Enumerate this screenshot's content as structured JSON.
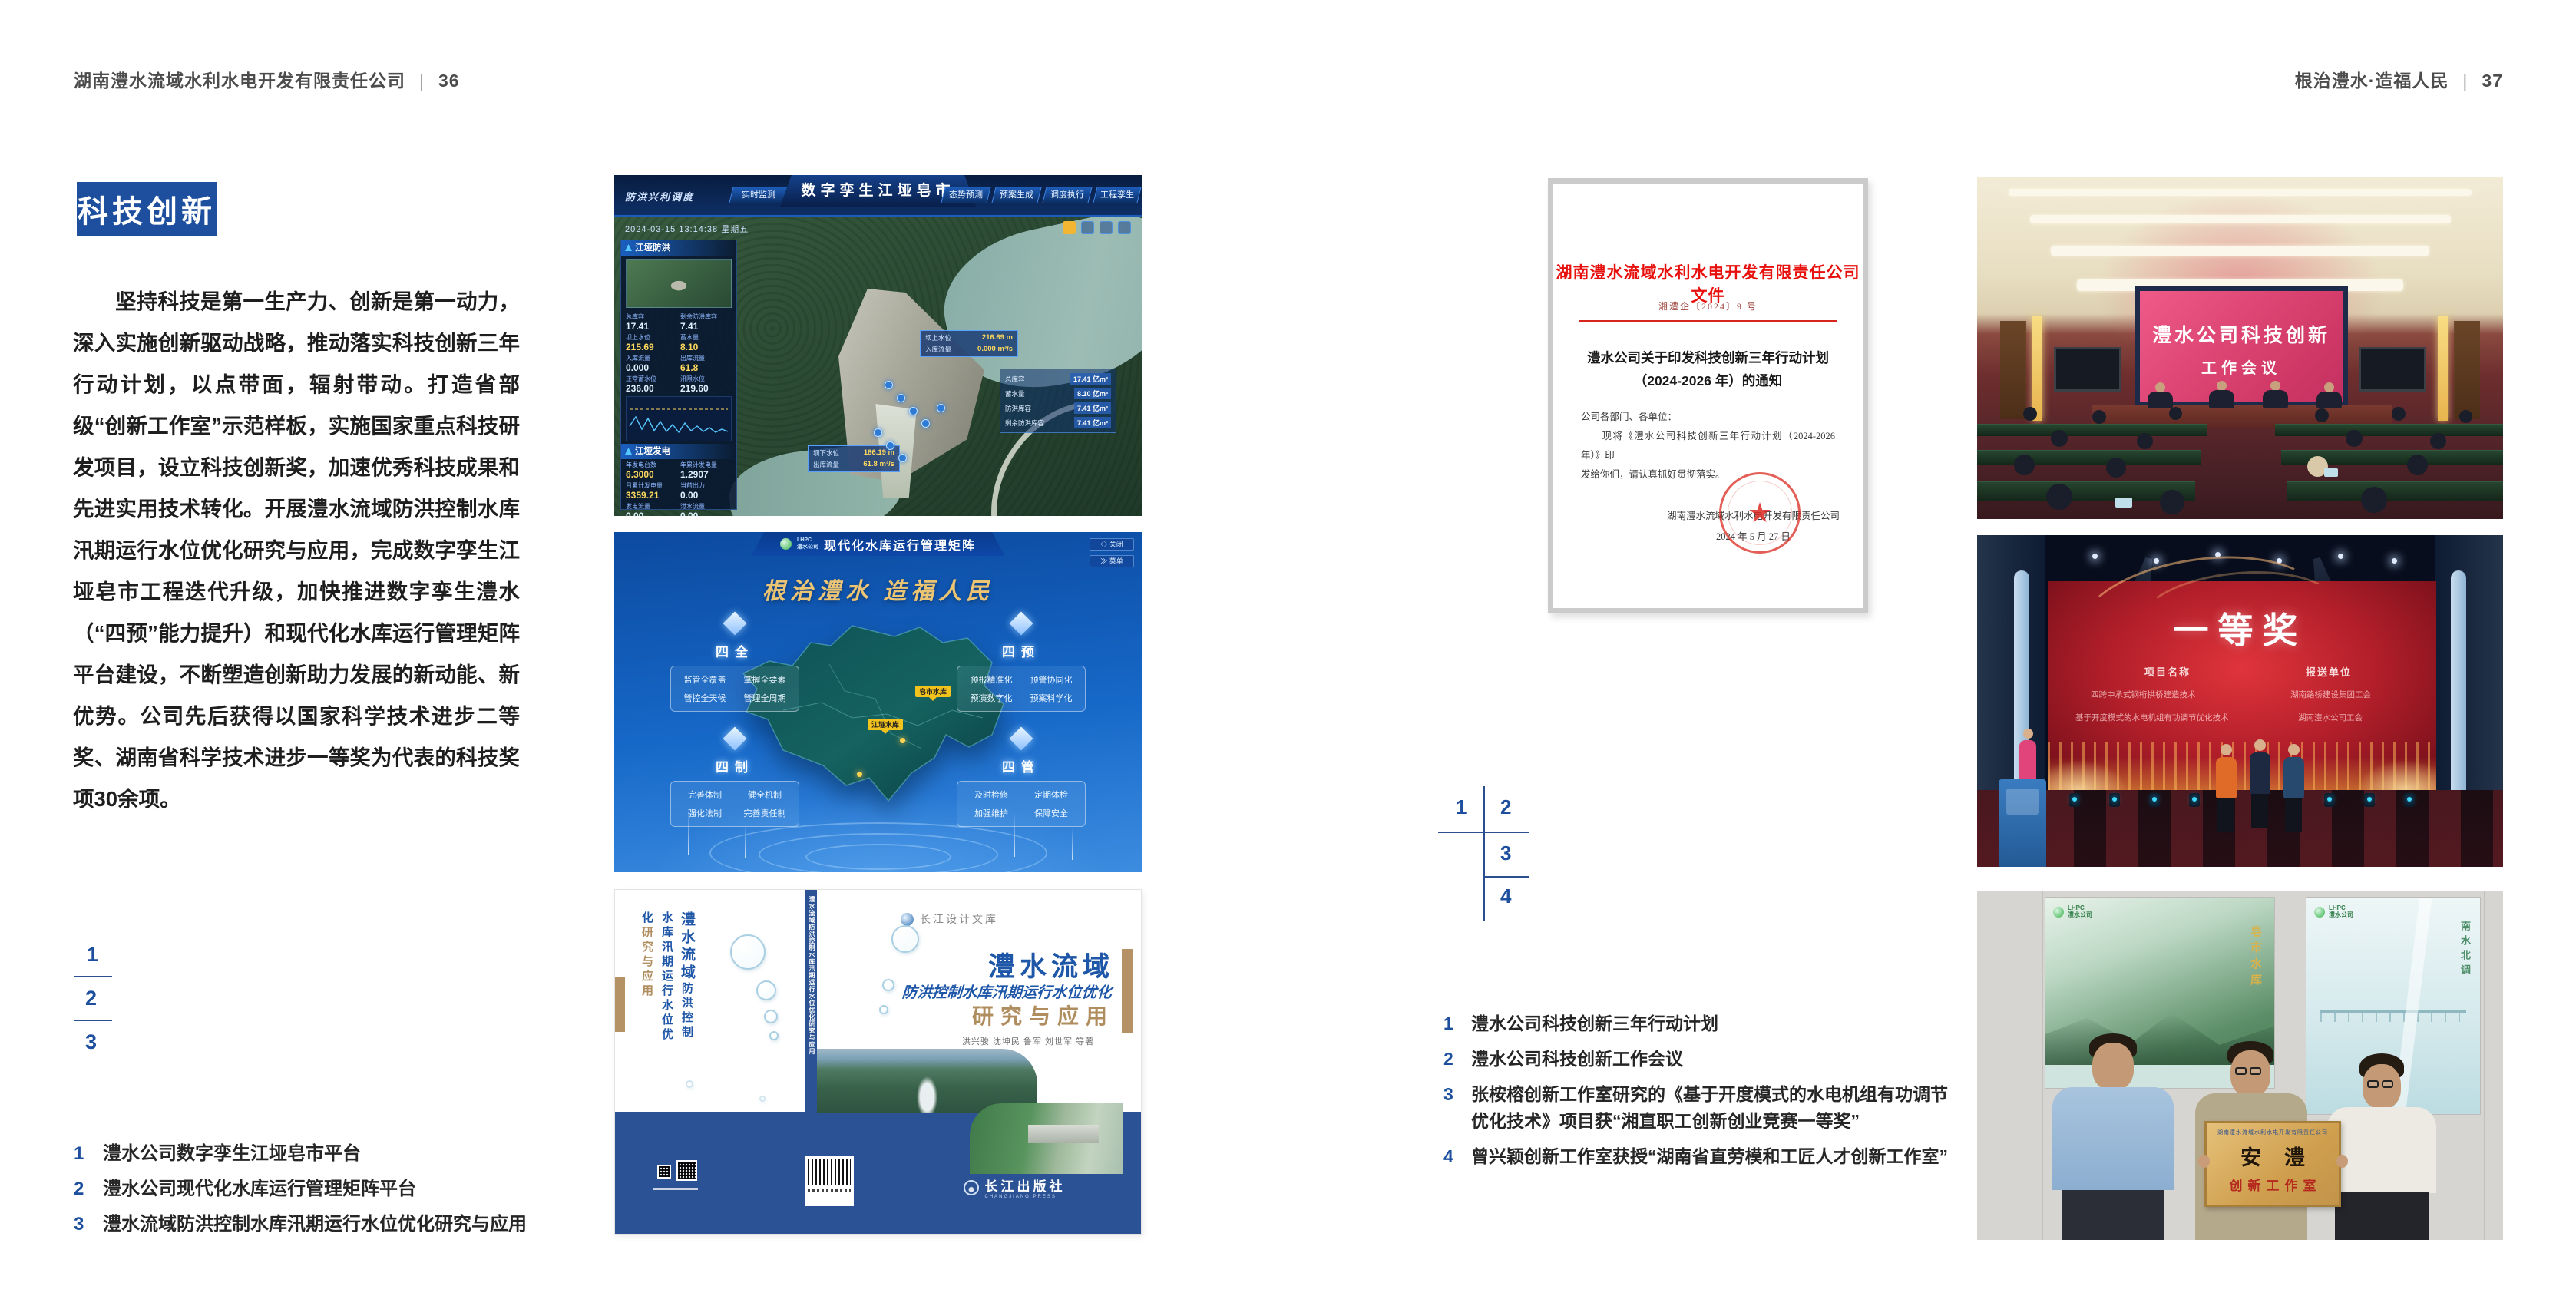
{
  "accent_blue": "#1d4f9e",
  "left_page": {
    "header": {
      "title": "湖南澧水流域水利水电开发有限责任公司",
      "divider": "|",
      "page_no": "36"
    },
    "section_title": "科技创新",
    "paragraph": "坚持科技是第一生产力、创新是第一动力，深入实施创新驱动战略，推动落实科技创新三年行动计划，以点带面，辐射带动。打造省部级“创新工作室”示范样板，实施国家重点科技研发项目，设立科技创新奖，加速优秀科技成果和先进实用技术转化。开展澧水流域防洪控制水库汛期运行水位优化研究与应用，完成数字孪生江垭皂市工程迭代升级，加快推进数字孪生澧水（“四预”能力提升）和现代化水库运行管理矩阵平台建设，不断塑造创新助力发展的新动能、新优势。公司先后获得以国家科学技术进步二等奖、湖南省科学技术进步一等奖为代表的科技奖项30余项。",
    "figure_numbers": [
      "1",
      "2",
      "3"
    ],
    "captions": [
      {
        "num": "1",
        "text": "澧水公司数字孪生江垭皂市平台"
      },
      {
        "num": "2",
        "text": "澧水公司现代化水库运行管理矩阵平台"
      },
      {
        "num": "3",
        "text": "澧水流域防洪控制水库汛期运行水位优化研究与应用"
      }
    ],
    "fig_dt": {
      "title": "数字孪生江垭皂市",
      "module": "防洪兴利调度",
      "tabs_left": [
        "实时监测",
        "洪水预报",
        "防洪预警"
      ],
      "tabs_right": [
        "态势预测",
        "预案生成",
        "调度执行",
        "工程孪生"
      ],
      "timestamp": "2024-03-15 13:14:38 星期五",
      "panel_flood": {
        "title": "江垭防洪",
        "stats": [
          {
            "l": "总库容",
            "v": "17.41"
          },
          {
            "l": "剩余防洪库容",
            "v": "7.41"
          },
          {
            "l": "坝上水位",
            "v": "215.69"
          },
          {
            "l": "蓄水量",
            "v": "8.10"
          },
          {
            "l": "入库流量",
            "v": "0.000"
          },
          {
            "l": "出库流量",
            "v": "61.8"
          },
          {
            "l": "正常蓄水位",
            "v": "236.00"
          },
          {
            "l": "汛限水位",
            "v": "219.60"
          }
        ],
        "legend": "◆ 坝上水位　◆ 入库流量　◆ 出库流量"
      },
      "panel_power": {
        "title": "江垭发电",
        "stats": [
          {
            "l": "年发电台数",
            "v": "6.3000"
          },
          {
            "l": "年累计发电量",
            "v": "1.2907"
          },
          {
            "l": "月累计发电量",
            "v": "3359.21"
          },
          {
            "l": "当前出力",
            "v": "0.00"
          },
          {
            "l": "发电流量",
            "v": "0.00"
          },
          {
            "l": "泄水流量",
            "v": "0.00"
          }
        ]
      },
      "tag_upper": {
        "rows": [
          {
            "l": "坝上水位",
            "v": "216.69 m"
          },
          {
            "l": "入库流量",
            "v": "0.000 m³/s"
          }
        ]
      },
      "tag_lower": {
        "rows": [
          {
            "l": "坝下水位",
            "v": "186.19 m"
          },
          {
            "l": "出库流量",
            "v": "61.8 m³/s"
          }
        ]
      },
      "info_panel": {
        "rows": [
          {
            "l": "总库容",
            "v": "17.41 亿m³"
          },
          {
            "l": "蓄水量",
            "v": "8.10 亿m³"
          },
          {
            "l": "防洪库容",
            "v": "7.41 亿m³"
          },
          {
            "l": "剩余防洪库容",
            "v": "7.41 亿m³"
          }
        ]
      }
    },
    "fig_matrix": {
      "logo_line1": "LHPC",
      "logo_line2": "澧水公司",
      "title": "现代化水库运行管理矩阵",
      "btn_close": "◇ 关闭",
      "btn_menu": "≫ 菜单",
      "slogan": "根治澧水 造福人民",
      "groups": [
        {
          "name": "四全",
          "items": [
            "监管全覆盖",
            "掌握全要素",
            "管控全天候",
            "管理全周期"
          ]
        },
        {
          "name": "四预",
          "items": [
            "预报精准化",
            "预警协同化",
            "预演数字化",
            "预案科学化"
          ]
        },
        {
          "name": "四制",
          "items": [
            "完善体制",
            "健全机制",
            "强化法制",
            "完善责任制"
          ]
        },
        {
          "name": "四管",
          "items": [
            "及时检修",
            "定期体检",
            "加强维护",
            "保障安全"
          ]
        }
      ],
      "markers": [
        "皂市水库",
        "江垭水库"
      ]
    },
    "fig_book": {
      "series": "长江设计文库",
      "title": "澧水流域",
      "subtitle": "防洪控制水库汛期运行水位优化",
      "title2": "研究与应用",
      "authors": "洪兴骏  沈坤民  鲁军  刘世军  等著",
      "spine_text": "澧水流域防洪控制水库汛期运行水位优化研究与应用",
      "back_title1": "澧水流域",
      "back_title2": "防洪控制水库汛期运行水位优化",
      "back_title3": "研究与应用",
      "publisher": "长江出版社",
      "publisher_en": "CHANGJIANG PRESS"
    }
  },
  "right_page": {
    "header": {
      "title": "根治澧水·造福人民",
      "divider": "|",
      "page_no": "37"
    },
    "figure_numbers": [
      "1",
      "2",
      "3",
      "4"
    ],
    "captions": [
      {
        "num": "1",
        "line1": "澧水公司科技创新三年行动计划",
        "line2": ""
      },
      {
        "num": "2",
        "line1": "澧水公司科技创新工作会议",
        "line2": ""
      },
      {
        "num": "3",
        "line1": "张桉榕创新工作室研究的《基于开度模式的水电机组有功调节",
        "line2": "优化技术》项目获“湘直职工创新创业竞赛一等奖”"
      },
      {
        "num": "4",
        "line1": "曾兴颖创新工作室获授“湖南省直劳模和工匠人才创新工作室”",
        "line2": ""
      }
    ],
    "fig_doc": {
      "letterhead": "湖南澧水流域水利水电开发有限责任公司文件",
      "doc_no": "湘澧企〔2024〕9 号",
      "title1": "澧水公司关于印发科技创新三年行动计划",
      "title2": "（2024-2026 年）的通知",
      "salutation": "公司各部门、各单位：",
      "body1": "　　现将《澧水公司科技创新三年行动计划（2024-2026 年）》印",
      "body2": "发给你们，请认真抓好贯彻落实。",
      "signer": "湖南澧水流域水利水电开发有限责任公司",
      "date": "2024 年 5 月 27 日",
      "star": "★"
    },
    "fig_meeting": {
      "screen1": "澧水公司科技创新",
      "screen2": "工作会议"
    },
    "fig_award": {
      "prize": "一等奖",
      "col1_header": "项目名称",
      "col2_header": "报送单位",
      "col1_items": [
        "四跨中承式钢桁拱桥建造技术",
        "基于开度模式的水电机组有功调节优化技术"
      ],
      "col2_items": [
        "湖南路桥建设集团工会",
        "湖南澧水公司工会"
      ]
    },
    "fig_group": {
      "plaque_header": "湖南澧水流域水利水电开发有限责任公司",
      "plaque_char1": "安",
      "plaque_char2": "澧",
      "plaque_sub": "创新工作室",
      "posterL_logo_line1": "LHPC",
      "posterL_logo_line2": "澧水公司",
      "posterL_caption": "皂市水库",
      "posterR_logo_line1": "LHPC",
      "posterR_logo_line2": "澧水公司",
      "posterR_caption": "南水北调"
    }
  }
}
